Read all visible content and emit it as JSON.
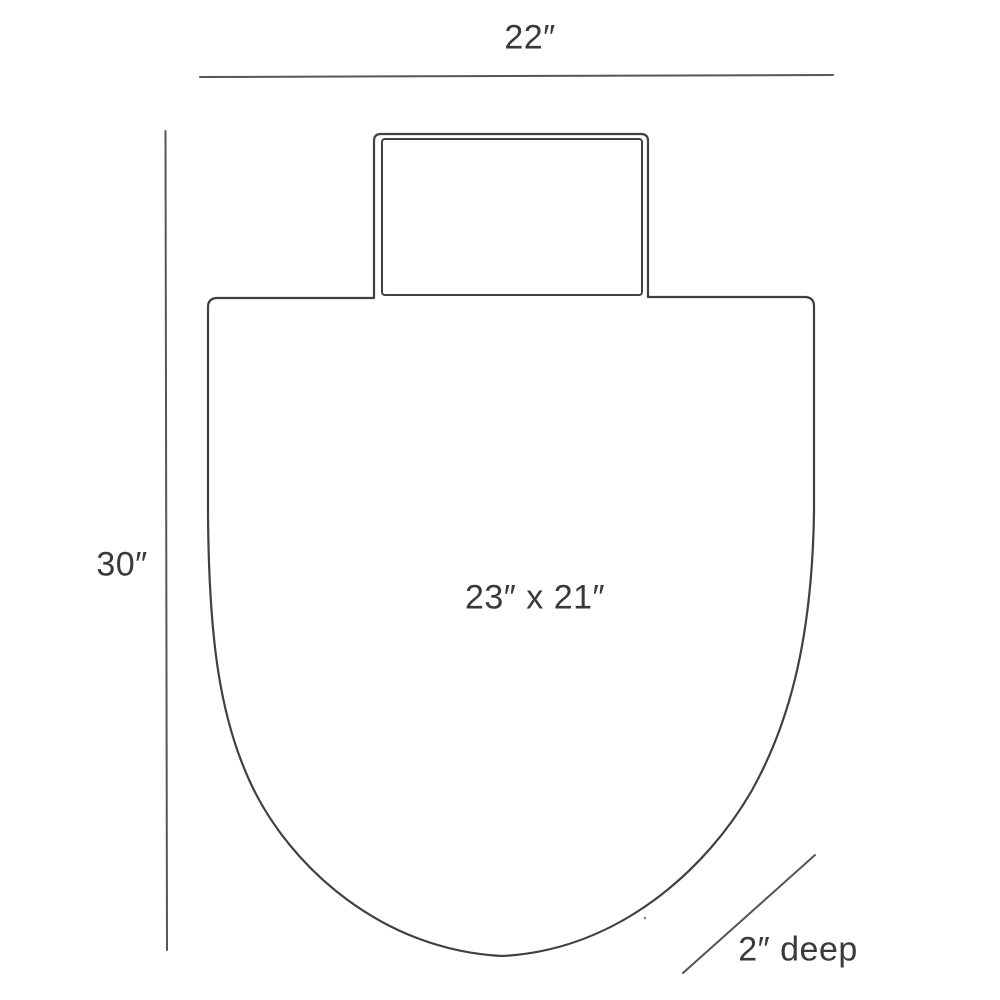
{
  "diagram": {
    "kind": "product-dimension-drawing",
    "labels": {
      "top_width": "22″",
      "left_height": "30″",
      "center_size": "23″ x 21″",
      "depth": "2″ deep"
    },
    "colors": {
      "dimension_line": "#555555",
      "outline": "#404040",
      "text": "#3a3a3a",
      "background": "#ffffff"
    }
  }
}
